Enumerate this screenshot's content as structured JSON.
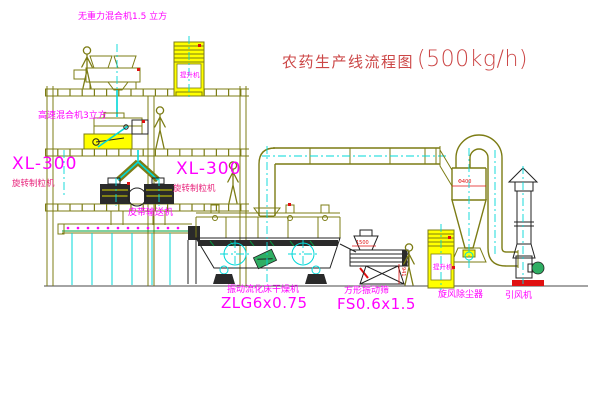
{
  "diagram": {
    "title": "农药生产线流程图",
    "title_capacity": "(500kg/h)",
    "equipment": {
      "gravity_mixer": {
        "label": "无重力混合机1.5 立方"
      },
      "high_speed_mixer": {
        "label": "高速混合机3立方"
      },
      "granulator_left": {
        "model": "XL-300",
        "name": "旋转制粒机"
      },
      "granulator_mid": {
        "model": "XL-300",
        "name": "旋转制粒机"
      },
      "bucket_elevator_top": {
        "label": "提升机"
      },
      "bucket_elevator_right": {
        "label": "提升机"
      },
      "belt_conveyor": {
        "label": "皮带输送机"
      },
      "fluid_bed_dryer": {
        "name": "振动流化床干燥机",
        "model": "ZLG6x0.75"
      },
      "vibrating_screen": {
        "name": "方形振动筛",
        "model": "FS0.6x1.5"
      },
      "cyclone": {
        "label": "旋风除尘器",
        "dia_mark": "Φ400"
      },
      "fan": {
        "label": "引风机"
      }
    },
    "dimensions": {
      "screen_width": "1500",
      "screen_height": "941"
    }
  },
  "colors": {
    "line_olive": "#7c7c14",
    "machine_dark": "#222222",
    "centerline_cyan": "#00d8d8",
    "fill_yellow": "#ffff00",
    "label_magenta": "#ff00ff",
    "title_red": "#cc4747",
    "dim_red": "#e01010",
    "detail_green": "#00a040"
  }
}
